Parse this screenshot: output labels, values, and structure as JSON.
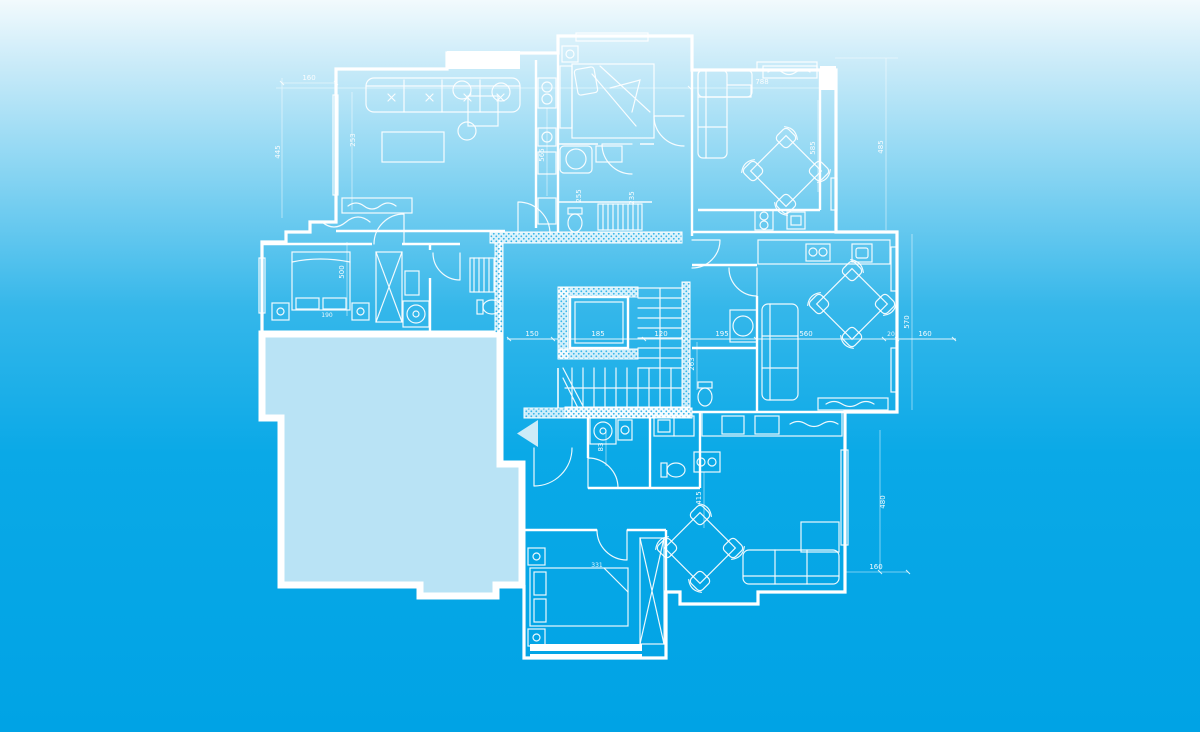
{
  "colors": {
    "line": "#ffffff",
    "background_top": "#f2fafd",
    "background_light": "#cdecf9",
    "background_upper": "#8fd7f3",
    "background_mid": "#35b7ea",
    "background_deep": "#0aa9e7",
    "background_bottom": "#00a3e5",
    "terrace_fill": "#b9e3f5",
    "arrow_fill": "#cdebf8",
    "hatch_dot": "#35b5ea"
  },
  "plan": {
    "type": "architectural blueprint floor plan",
    "entrance_arrow": {
      "direction": "left"
    },
    "dimension_labels": [
      "160",
      "445",
      "253",
      "500",
      "190",
      "565",
      "255",
      "235",
      "788",
      "585",
      "485",
      "150",
      "185",
      "120",
      "195",
      "560",
      "20",
      "160",
      "570",
      "263",
      "480",
      "160",
      "331",
      "415",
      "83"
    ]
  }
}
